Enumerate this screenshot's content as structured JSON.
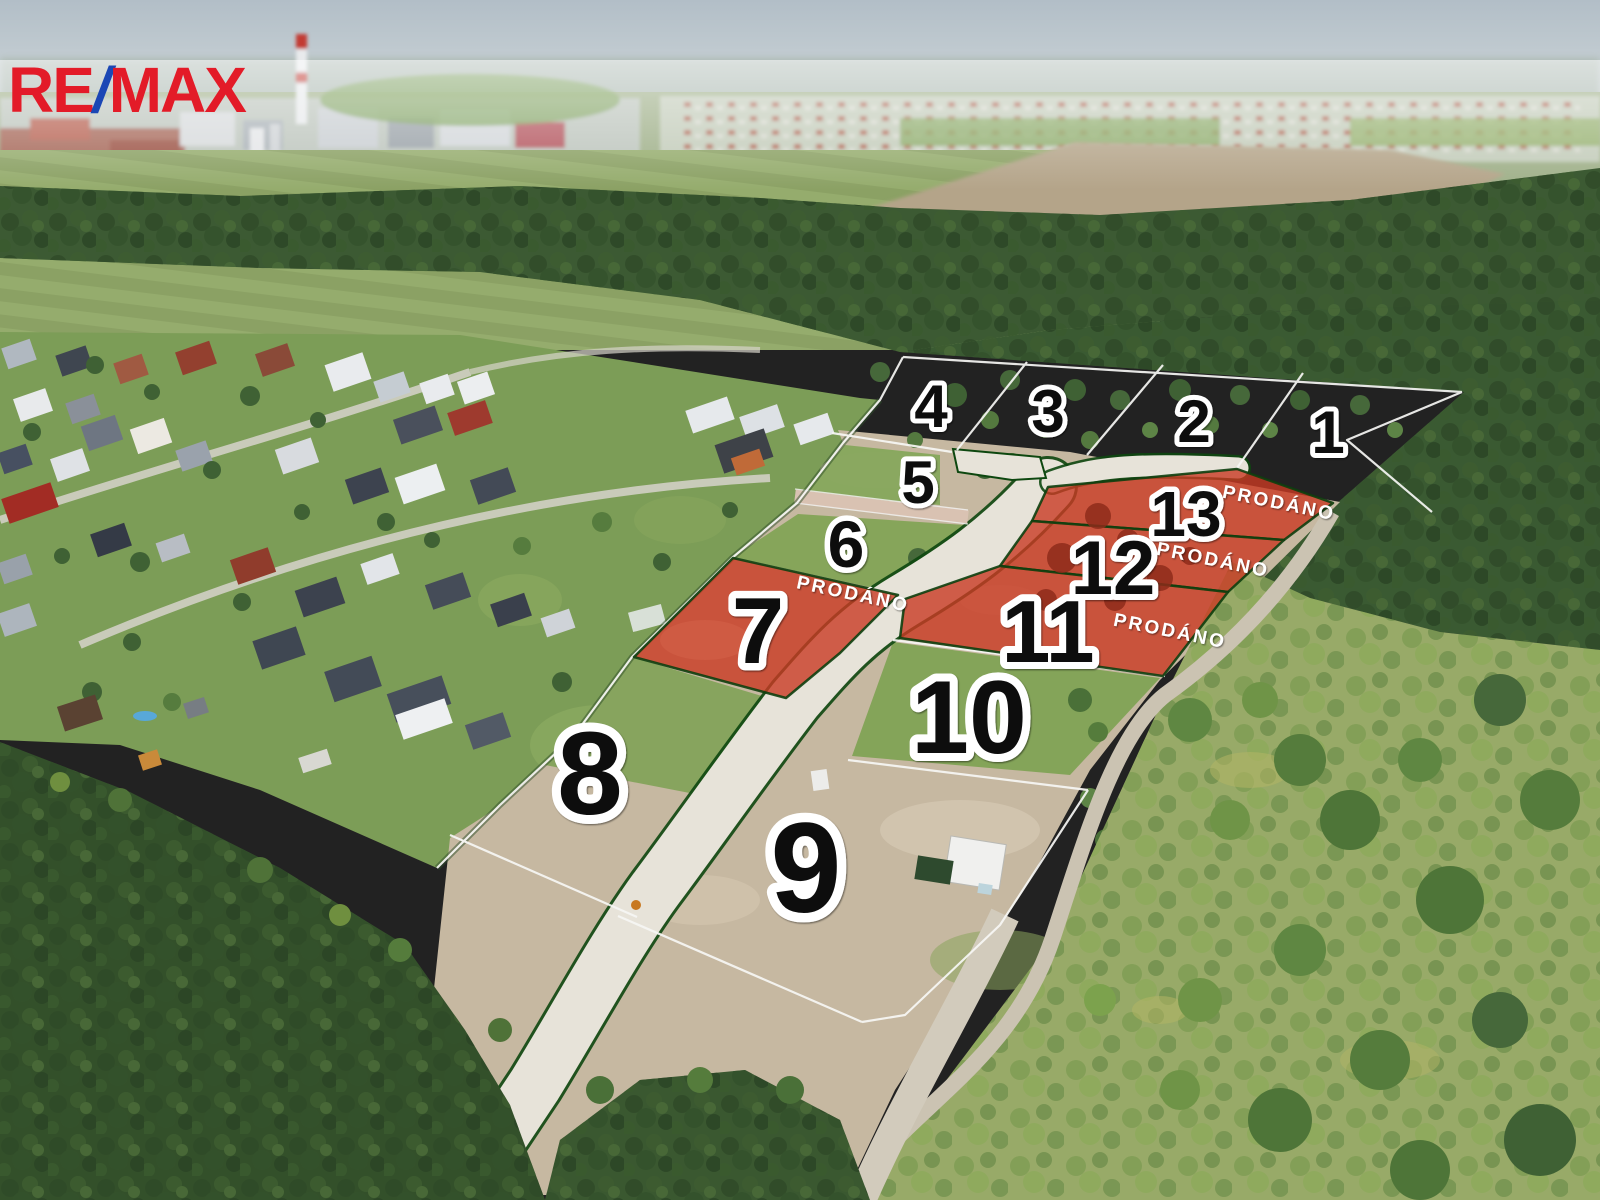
{
  "branding": {
    "re": "RE",
    "slash": "/",
    "max": "MAX"
  },
  "labels": {
    "sold": "PRODÁNO"
  },
  "colors": {
    "sold_overlay": "#C93A23",
    "sold_border": "#0D3F0E",
    "boundary_line": "#FFFFFF",
    "road_edge_green": "#0D470F",
    "logo_red": "#E31B28",
    "logo_blue": "#1B47B5"
  },
  "plots": [
    {
      "number": "1",
      "status": ""
    },
    {
      "number": "2",
      "status": ""
    },
    {
      "number": "3",
      "status": ""
    },
    {
      "number": "4",
      "status": ""
    },
    {
      "number": "5",
      "status": ""
    },
    {
      "number": "6",
      "status": ""
    },
    {
      "number": "7",
      "status": "PRODÁNO"
    },
    {
      "number": "8",
      "status": ""
    },
    {
      "number": "9",
      "status": ""
    },
    {
      "number": "10",
      "status": ""
    },
    {
      "number": "11",
      "status": "PRODÁNO"
    },
    {
      "number": "12",
      "status": "PRODÁNO"
    },
    {
      "number": "13",
      "status": "PRODÁNO"
    }
  ]
}
